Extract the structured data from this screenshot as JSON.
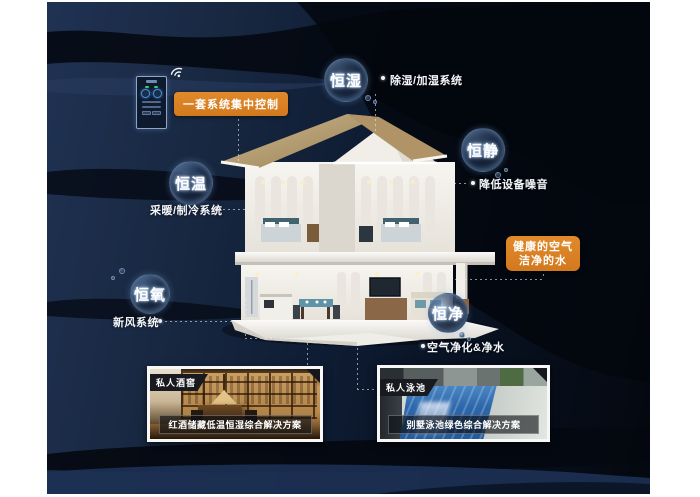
{
  "poster": {
    "control": {
      "label": "一套系统集中控制",
      "device": "smart-home-control-panel"
    },
    "bubbles": [
      {
        "id": "heng-shi",
        "title": "恒湿",
        "sub": "除湿/加湿系统"
      },
      {
        "id": "heng-jing",
        "title": "恒静",
        "sub": "降低设备噪音"
      },
      {
        "id": "heng-wen",
        "title": "恒温",
        "sub": "采暖/制冷系统"
      },
      {
        "id": "heng-yang",
        "title": "恒氧",
        "sub": "新风系统"
      },
      {
        "id": "heng-jin",
        "title": "恒净",
        "sub": "空气净化&净水"
      }
    ],
    "highlight": {
      "line1": "健康的空气",
      "line2": "洁净的水"
    },
    "cards": [
      {
        "badge": "私人酒窖",
        "caption": "红酒储藏低温恒湿综合解决方案"
      },
      {
        "badge": "私人泳池",
        "caption": "别墅泳池绿色综合解决方案"
      }
    ],
    "icons": [
      {
        "name": "wifi-icon",
        "meaning": "wireless centralized control"
      }
    ],
    "colors": {
      "accent_orange": "#DB8226",
      "background_navy": "#13223B",
      "bubble_text": "#FFFFFF"
    }
  }
}
